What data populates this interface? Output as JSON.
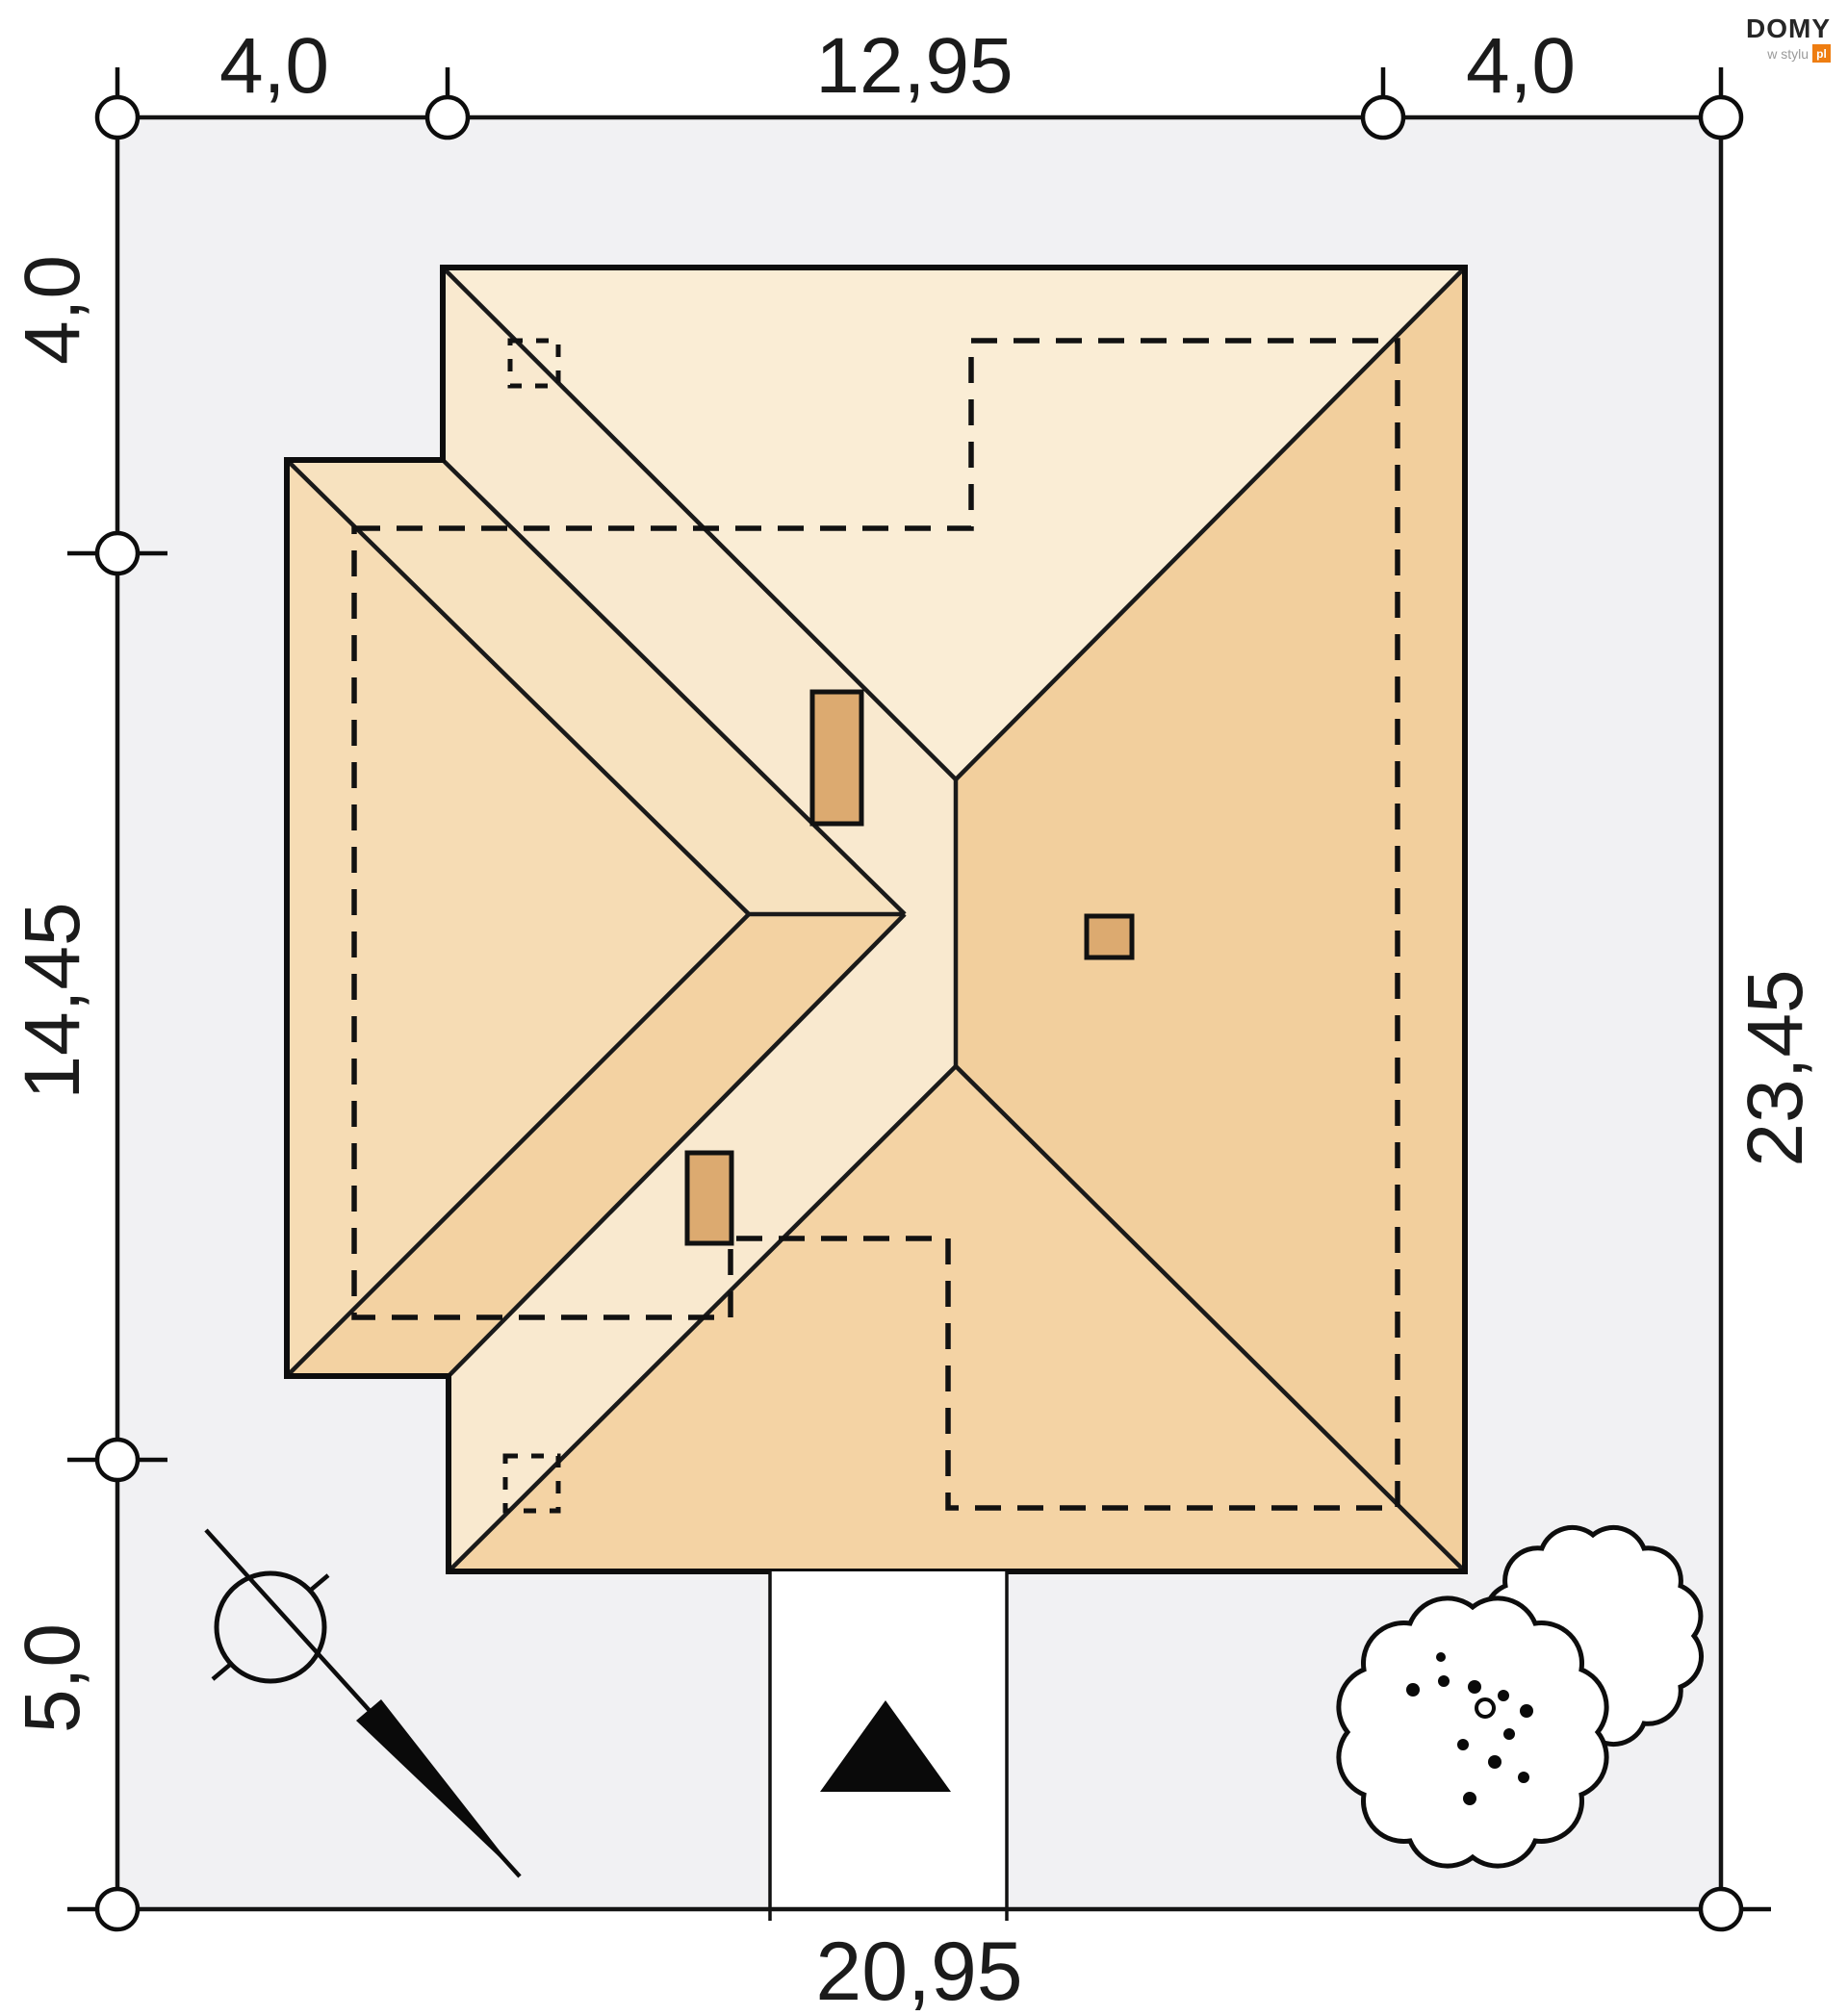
{
  "logo": {
    "brand": "DOMY",
    "tagline": "w stylu",
    "suffix": "pl",
    "accent": "#EE7D11"
  },
  "plan": {
    "dimensions": {
      "top": [
        "4,0",
        "12,95",
        "4,0"
      ],
      "left": [
        "4,0",
        "14,45",
        "5,0"
      ],
      "right": "23,45",
      "bottom": "20,95"
    },
    "colors": {
      "plot_fill": "#F1F1F3",
      "line": "#1A1A1A",
      "roof_north": "#FAEDD5",
      "roof_west": "#F9E9CF",
      "roof_east": "#F2CF9D",
      "roof_south": "#F4D3A4",
      "wing_north": "#F7E2BF",
      "wing_west": "#F6DCB4",
      "wing_south": "#F3D2A2",
      "chimney": "#DCAA70",
      "driveway": "#FFFFFF"
    }
  }
}
